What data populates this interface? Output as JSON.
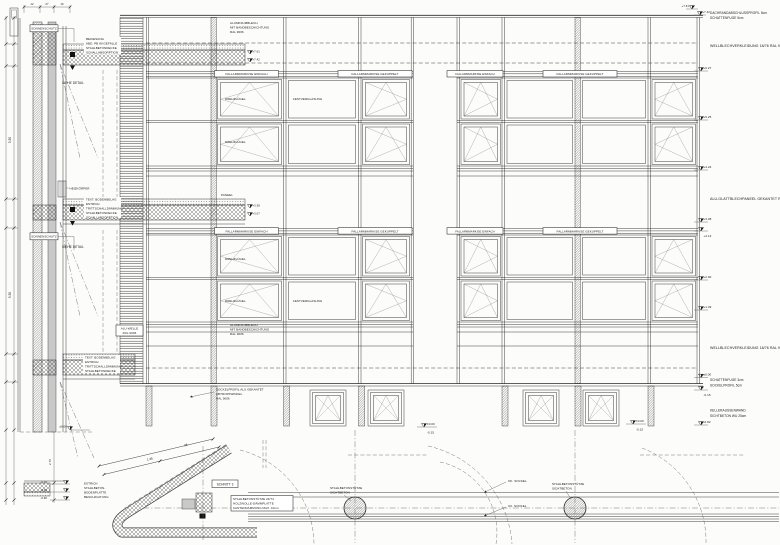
{
  "section": {
    "sonnenschutz": "SONNENSCHUTZ",
    "siehe_detail": "SIEHE DETAIL",
    "heizkoerper": "HEIZKÖRPER",
    "roof_note": [
      "BEKIESUNG",
      "ABD. PB IM GEFÄLLE",
      "STAHLBETONDECKE",
      "SCHALLABSORPTION"
    ],
    "floor_note": [
      "TEXT. BODENBELAG",
      "ESTRICH",
      "TRITTSCHALLDÄMMUNG",
      "STAHLBETONDECKE",
      "SCHALLABSORPTION"
    ],
    "floor_note2": [
      "TEXT. BODENBELAG",
      "ESTRICH",
      "TRITTSCHALLDÄMMUNG",
      "STAHLBETONDECKE"
    ],
    "base_note": [
      "ESTRICH",
      "STAHLBETON-",
      "BODENPLATTE",
      "BESCHICHTUNG"
    ],
    "levels": [
      "±0.00",
      "-0.15",
      "-0.36",
      "-0.90"
    ],
    "roof_levels": [
      "+7.61",
      "+7.42"
    ],
    "mid_levels": [
      "+3.38",
      "+3.07"
    ],
    "dims_top": [
      "12",
      "27",
      "16"
    ],
    "dim_storey1": "3.30",
    "dim_storey2": "3.30",
    "dim_base": "2.76"
  },
  "elevation": {
    "alublech": [
      "ALUMINIUMBLECH",
      "MIT BANDBESCHICHTUNG",
      "RAL 9006"
    ],
    "markise_single": "FALLARMMARKISE EINFACH",
    "markise_coupled": "FALLARMMARKISE GEKUPPELT",
    "drehfluegel": "DREHFLÜGEL",
    "festverglasung": "FESTVERGLASUNG",
    "paneel": "PANEEL",
    "alu_welle": [
      "ALU-WELLE",
      "RAL 9006"
    ],
    "sockel_note": [
      "SOCKELPROFIL ALU GEKANTET",
      "ABTROPFWINKEL",
      "RAL 9006"
    ]
  },
  "margin": {
    "note_top": [
      "DACHRANDABSCHLUSSPROFIL 5cm",
      "SCHATTENFUGE 5cm"
    ],
    "wellblech": "WELLBLECHVERKLEIDUNG  18/76  RAL 9006",
    "glattblech": "ALU-GLATTBLECHPANEEL GEKANTET  RAL 9006",
    "fuge": [
      "SCHATTENFUGE 3cm",
      "SOCKELPROFIL 5cm"
    ],
    "keller": [
      "KELLERAUSSENWAND",
      "SICHTBETON WU 25cm"
    ],
    "levels": [
      "+7.61",
      "+7.42",
      "+6.27",
      "+5.25",
      "+4.24",
      "+3.38",
      "+3.13",
      "+2.00",
      "+1.39",
      "±0.00",
      "-0.15",
      "-0.82"
    ]
  },
  "plan": {
    "schnitt": "SCHNITT 3",
    "stuetze_note": [
      "STAHLBETONSTÜTZE 24/74",
      "HOLZWOLLE-DÄMMPLATTE",
      "KANTENDÄMMUNG MAX. 10cm"
    ],
    "column_label": [
      "STAHLBETONSTÜTZE",
      "SICHTBETON"
    ],
    "ok_label": "OK. SOCKEL",
    "uk_label": "UK. SOCKEL",
    "levels": [
      "±0.00",
      "-0.15"
    ],
    "dims": [
      "1.35",
      "28"
    ]
  }
}
